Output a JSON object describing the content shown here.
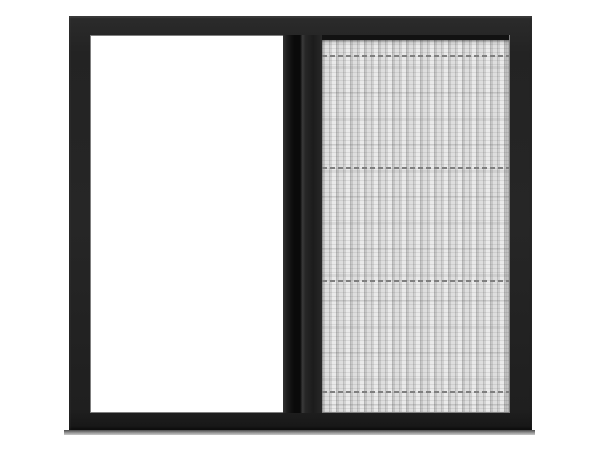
{
  "image": {
    "alt": "Product photo of a black aluminium sliding window, left half open showing white background, right half covered by a grey pleated insect mesh screen with a dark vertical slider rail in the middle and a soft shadow beneath the frame"
  },
  "colors": {
    "frame": "#242424",
    "frame-top": "#2b2b2b",
    "frame-dark": "#161616",
    "opening": "#ffffff",
    "track": "#121212",
    "divider-dark": "#0a0a0a",
    "divider-mid": "#1e1e1e",
    "divider-light": "#333333",
    "mesh-base": "#eaeaea",
    "mesh-pleat": "#c3c3c3",
    "seam": "#7f7f7f",
    "shadow-dark": "#4a4a4a",
    "shadow-mid": "#969696",
    "shadow-light": "#c8c8c8",
    "page-bg": "#ffffff"
  },
  "mesh": {
    "pleat_period_px": 7,
    "seam_count": 4,
    "seam_style": "dashed"
  }
}
